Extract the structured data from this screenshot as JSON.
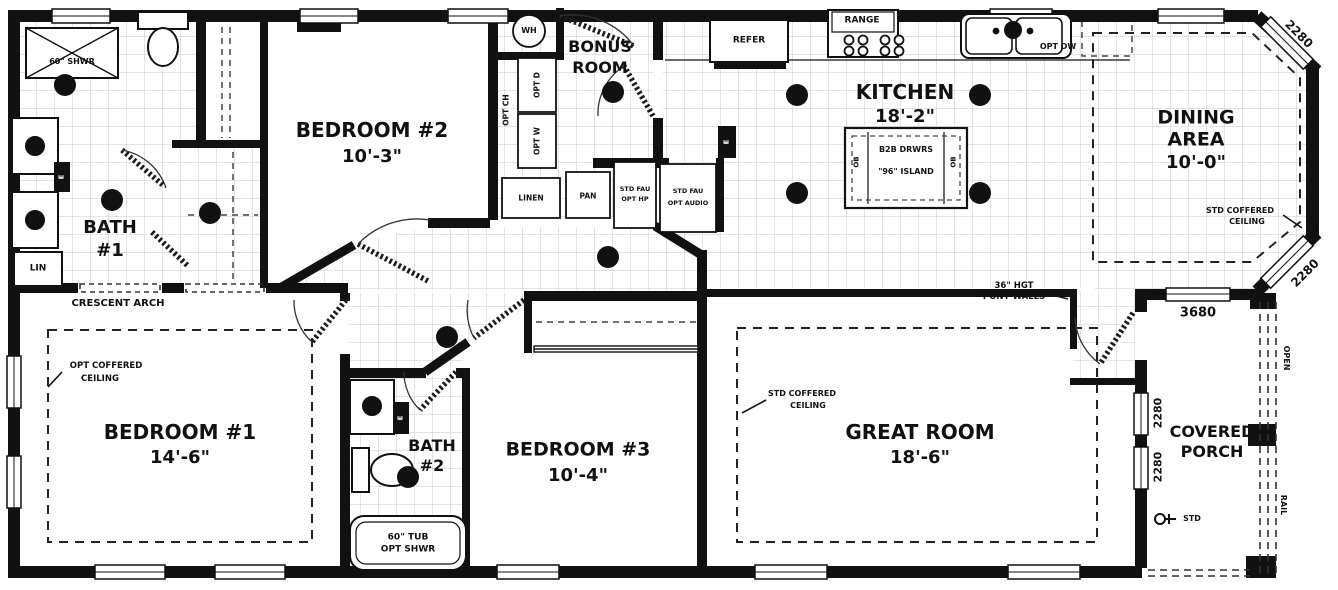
{
  "rooms": {
    "bath1": {
      "name": "BATH",
      "number": "#1"
    },
    "bedroom1": {
      "name": "BEDROOM #1",
      "dim": "14'-6\""
    },
    "bedroom2": {
      "name": "BEDROOM #2",
      "dim": "10'-3\""
    },
    "bedroom3": {
      "name": "BEDROOM #3",
      "dim": "10'-4\""
    },
    "bath2": {
      "name": "BATH",
      "number": "#2"
    },
    "bonus": {
      "name1": "BONUS",
      "name2": "ROOM"
    },
    "kitchen": {
      "name": "KITCHEN",
      "dim": "18'-2\""
    },
    "dining": {
      "name1": "DINING",
      "name2": "AREA",
      "dim": "10'-0\""
    },
    "great": {
      "name": "GREAT ROOM",
      "dim": "18'-6\""
    },
    "porch": {
      "name1": "COVERED",
      "name2": "PORCH"
    }
  },
  "fixtures": {
    "water_heater": "WH",
    "refrigerator": "REFER",
    "range": "RANGE",
    "opt_dishwasher": "OPT DW",
    "shower": "60\" SHWR",
    "tub1": "60\" TUB",
    "tub2": "OPT SHWR",
    "linen_small": "LIN",
    "linen": "LINEN",
    "pantry": "PAN",
    "opt_chase": "OPT CH",
    "opt_dryer": "OPT D",
    "opt_washer": "OPT W",
    "furnace1a": "STD FAU",
    "furnace1b": "OPT HP",
    "furnace2a": "STD FAU",
    "furnace2b": "OPT AUDIO",
    "island1": "B2B DRWRS",
    "island2": "\"96\" ISLAND",
    "island_end": "OB",
    "hose_bib": "STD",
    "panel": "E"
  },
  "annotations": {
    "crescent_arch": "CRESCENT ARCH",
    "opt_coffered1": "OPT COFFERED",
    "opt_coffered2": "CEILING",
    "std_coffered1": "STD COFFERED",
    "std_coffered2": "CEILING",
    "pony1": "36\" HGT",
    "pony2": "PONY WALLS",
    "open": "OPEN",
    "rail": "RAIL"
  },
  "dimensions": {
    "bay_window_top": "2280",
    "bay_window_bottom": "2280",
    "dining_porch_window": "3680",
    "porch_window1": "2280",
    "porch_window2": "2280"
  },
  "colors": {
    "wall": "#111111",
    "grid": "#c9c9c9",
    "background": "#ffffff"
  }
}
